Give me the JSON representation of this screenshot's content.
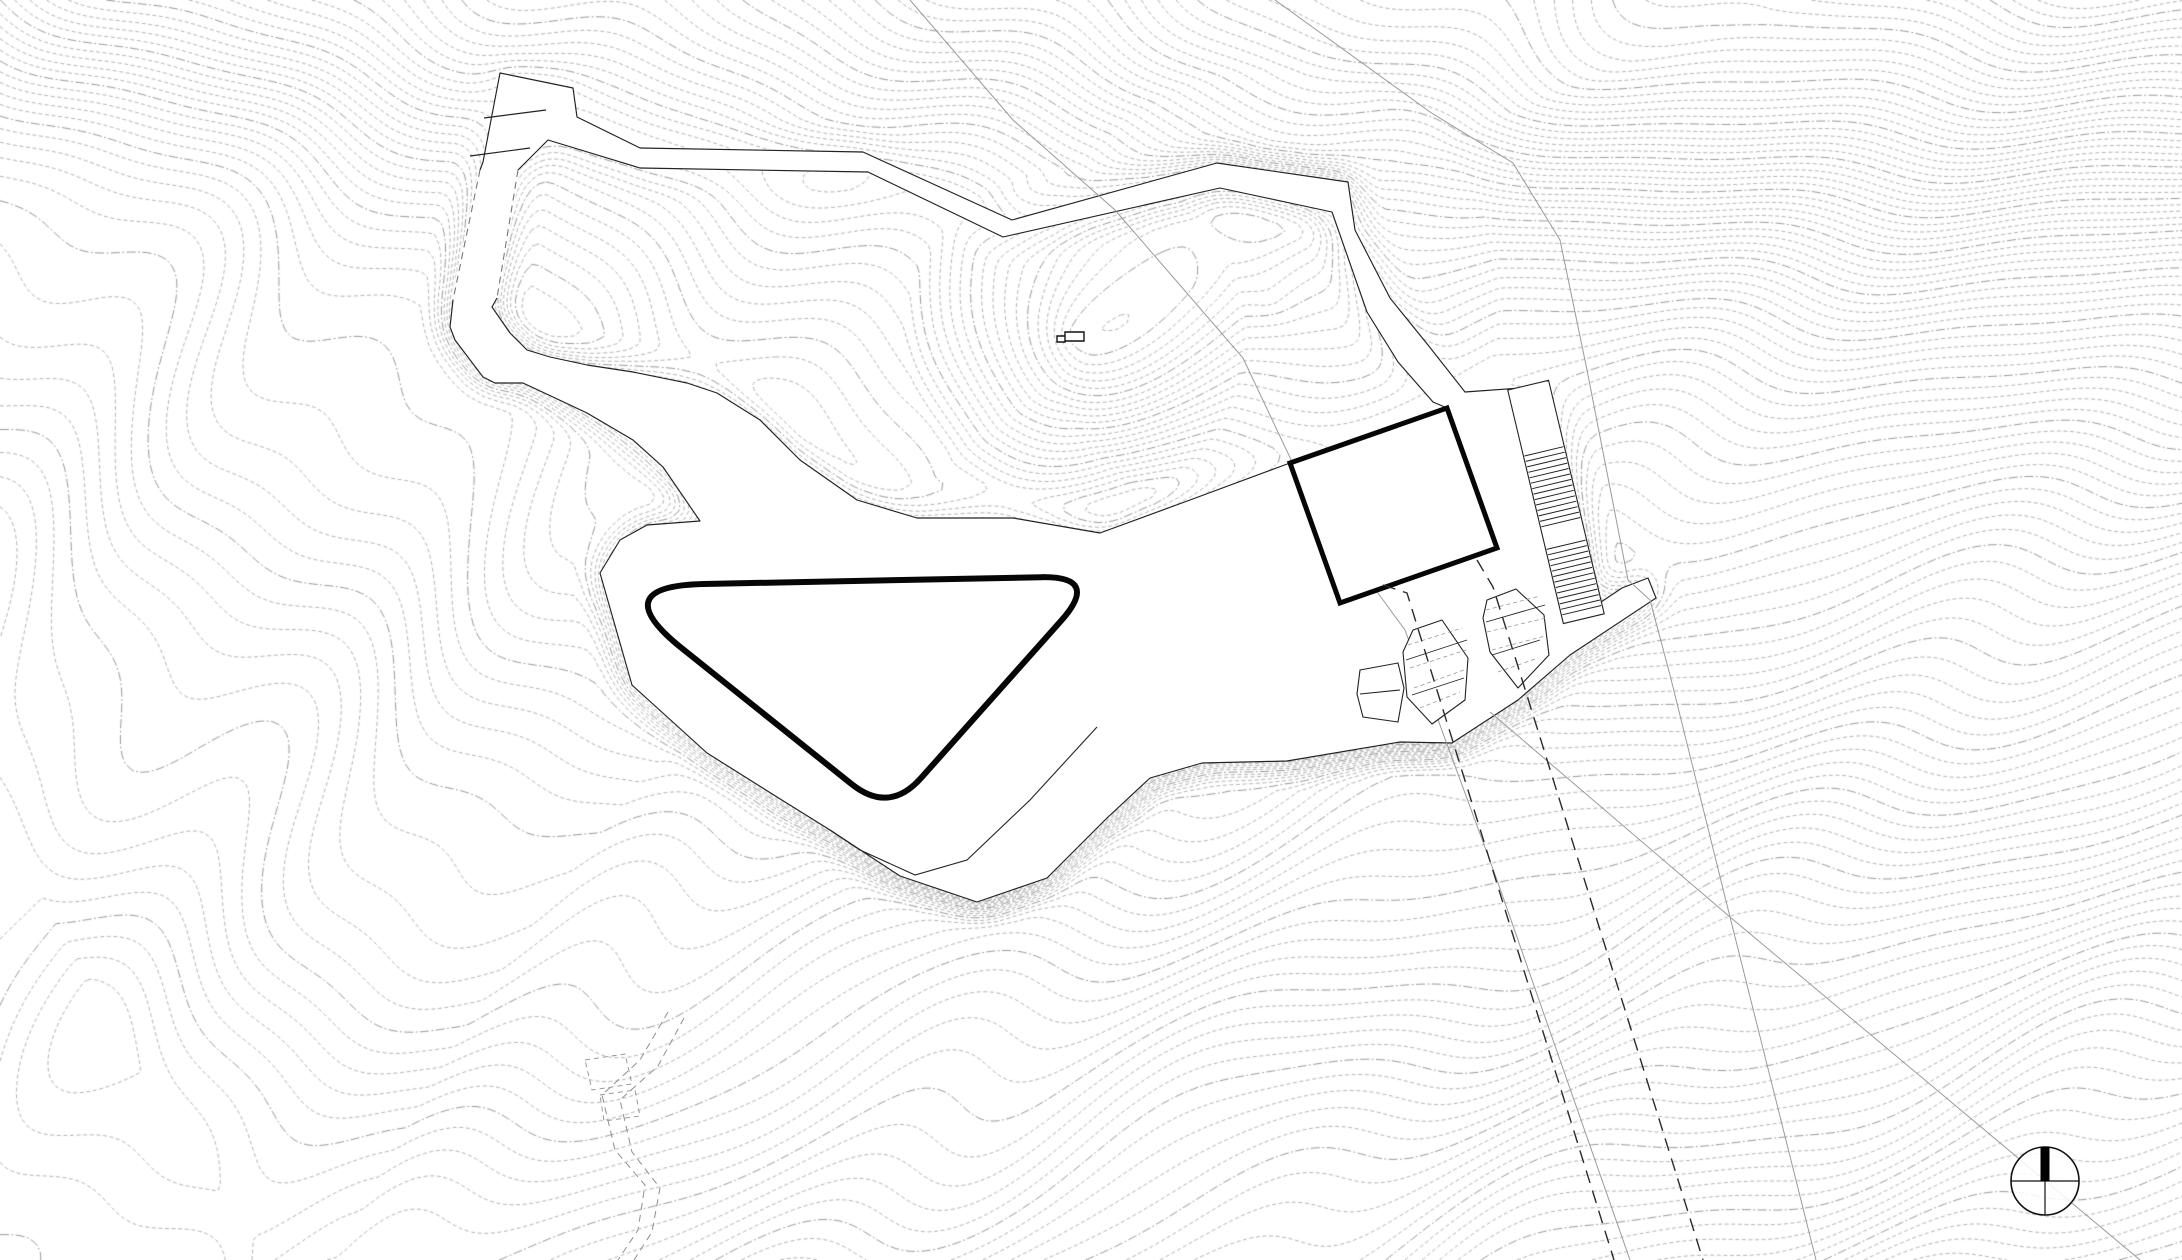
{
  "drawing": {
    "kind": "architectural-site-plan-topographic",
    "width": 2182,
    "height": 1260,
    "colors": {
      "background": "#ffffff",
      "contour": "#9c9c9c",
      "contour_index": "#8f8f8f",
      "outline": "#222222",
      "heavy": "#060606",
      "survey": "#9a9a9a",
      "centerline": "#2a2a2a",
      "trail": "#8f8f8f"
    },
    "plateau_level": 32,
    "terrain": {
      "cones": [
        {
          "cx": 2350,
          "cy": -300,
          "r": 2600,
          "a": 100
        },
        {
          "cx": 2500,
          "cy": 2300,
          "r": 2400,
          "a": -90
        },
        {
          "cx": 1075,
          "cy": 338,
          "r": 170,
          "a": 11
        },
        {
          "cx": 1270,
          "cy": 300,
          "r": 230,
          "a": 8
        }
      ],
      "tilt_x": -0.013,
      "upland": {
        "amp": 22,
        "y0": 60,
        "slope": 0.06,
        "k": 60
      },
      "waves": [
        {
          "ax": 0.016,
          "ay": 0.009,
          "amp": 1.3
        },
        {
          "ax": 0.006,
          "ay": -0.014,
          "amp": 0.9
        },
        {
          "ax": 0.028,
          "ay": 0.021,
          "amp": 0.55
        }
      ],
      "cell": 7,
      "level_step": 1,
      "index_every": 5
    },
    "pad_outer": [
      [
        500,
        73
      ],
      [
        573,
        88
      ],
      [
        577,
        117
      ],
      [
        640,
        148
      ],
      [
        863,
        152
      ],
      [
        1012,
        220
      ],
      [
        1217,
        163
      ],
      [
        1348,
        182
      ],
      [
        1355,
        230
      ],
      [
        1390,
        298
      ],
      [
        1428,
        345
      ],
      [
        1465,
        392
      ],
      [
        1549,
        386
      ],
      [
        1601,
        602
      ],
      [
        1622,
        588
      ],
      [
        1648,
        578
      ],
      [
        1656,
        598
      ],
      [
        1570,
        655
      ],
      [
        1518,
        700
      ],
      [
        1452,
        743
      ],
      [
        1400,
        742
      ],
      [
        1287,
        761
      ],
      [
        1202,
        763
      ],
      [
        1150,
        778
      ],
      [
        1107,
        818
      ],
      [
        1047,
        878
      ],
      [
        977,
        902
      ],
      [
        900,
        876
      ],
      [
        830,
        830
      ],
      [
        785,
        802
      ],
      [
        707,
        753
      ],
      [
        632,
        685
      ],
      [
        600,
        573
      ],
      [
        620,
        540
      ],
      [
        647,
        525
      ],
      [
        700,
        521
      ],
      [
        663,
        467
      ],
      [
        633,
        440
      ],
      [
        587,
        413
      ],
      [
        553,
        397
      ],
      [
        523,
        383
      ],
      [
        495,
        383
      ],
      [
        483,
        377
      ],
      [
        455,
        340
      ],
      [
        450,
        327
      ],
      [
        453,
        300
      ],
      [
        480,
        170
      ],
      [
        483,
        162
      ]
    ],
    "knoll_hole": [
      [
        548,
        140
      ],
      [
        640,
        168
      ],
      [
        868,
        172
      ],
      [
        1003,
        237
      ],
      [
        1220,
        188
      ],
      [
        1332,
        212
      ],
      [
        1367,
        312
      ],
      [
        1398,
        362
      ],
      [
        1433,
        402
      ],
      [
        1447,
        408
      ],
      [
        1290,
        463
      ],
      [
        1190,
        500
      ],
      [
        1100,
        533
      ],
      [
        1013,
        518
      ],
      [
        917,
        518
      ],
      [
        857,
        500
      ],
      [
        800,
        460
      ],
      [
        760,
        420
      ],
      [
        717,
        393
      ],
      [
        687,
        383
      ],
      [
        633,
        372
      ],
      [
        587,
        365
      ],
      [
        550,
        357
      ],
      [
        527,
        350
      ],
      [
        510,
        333
      ],
      [
        492,
        307
      ],
      [
        497,
        298
      ],
      [
        518,
        170
      ]
    ],
    "strip_dashed_edges": [
      [
        [
          480,
          170
        ],
        [
          453,
          300
        ]
      ],
      [
        [
          518,
          170
        ],
        [
          497,
          298
        ]
      ]
    ],
    "wall_ticks": [
      [
        [
          470,
          156
        ],
        [
          530,
          148
        ]
      ],
      [
        [
          484,
          118
        ],
        [
          546,
          110
        ]
      ]
    ],
    "pond": {
      "vertices": [
        [
          604,
          586
        ],
        [
          1101,
          576
        ],
        [
          889,
          814
        ]
      ],
      "corner_cut": [
        100,
        60,
        48
      ],
      "stroke_width": 6
    },
    "building": [
      [
        1290,
        463
      ],
      [
        1447,
        408
      ],
      [
        1497,
        548
      ],
      [
        1340,
        603
      ]
    ],
    "stairs": {
      "c0": [
        1530,
        393
      ],
      "c1": [
        1581,
        607
      ],
      "half_width": 21,
      "tread_half": 20,
      "corridor_s": [
        -8,
        232
      ],
      "flights": [
        {
          "s0": 60,
          "s1": 138,
          "step": 5.6
        },
        {
          "s0": 156,
          "s1": 226,
          "step": 5.6
        }
      ]
    },
    "terrace_planters": [
      {
        "poly": [
          [
            1413,
            630
          ],
          [
            1442,
            620
          ],
          [
            1468,
            658
          ],
          [
            1465,
            700
          ],
          [
            1432,
            724
          ],
          [
            1407,
            697
          ],
          [
            1403,
            652
          ]
        ],
        "inner": [
          [
            [
              1406,
              660
            ],
            [
              1467,
              640
            ]
          ],
          [
            [
              1412,
              695
            ],
            [
              1464,
              678
            ]
          ]
        ],
        "hatch": [
          [
            [
              1408,
              645
            ],
            [
              1462,
              628
            ]
          ],
          [
            [
              1410,
              668
            ],
            [
              1466,
              650
            ]
          ],
          [
            [
              1414,
              688
            ],
            [
              1464,
              670
            ]
          ],
          [
            [
              1420,
              708
            ],
            [
              1460,
              692
            ]
          ]
        ]
      },
      {
        "poly": [
          [
            1487,
            600
          ],
          [
            1516,
            589
          ],
          [
            1544,
            615
          ],
          [
            1549,
            655
          ],
          [
            1518,
            688
          ],
          [
            1490,
            652
          ],
          [
            1483,
            618
          ]
        ],
        "inner": [
          [
            [
              1486,
              622
            ],
            [
              1545,
              605
            ]
          ],
          [
            [
              1492,
              655
            ],
            [
              1540,
              640
            ]
          ]
        ],
        "hatch": [
          [
            [
              1486,
              610
            ],
            [
              1540,
              596
            ]
          ],
          [
            [
              1487,
              632
            ],
            [
              1546,
              618
            ]
          ],
          [
            [
              1492,
              650
            ],
            [
              1545,
              636
            ]
          ],
          [
            [
              1498,
              672
            ],
            [
              1538,
              658
            ]
          ]
        ]
      }
    ],
    "side_steps": {
      "poly": [
        [
          1360,
          670
        ],
        [
          1398,
          663
        ],
        [
          1404,
          688
        ],
        [
          1398,
          722
        ],
        [
          1363,
          717
        ],
        [
          1357,
          694
        ]
      ],
      "inner": [
        [
          [
            1360,
            694
          ],
          [
            1400,
            690
          ]
        ]
      ]
    },
    "lower_walk_inner_edge": [
      [
        1097,
        727
      ],
      [
        1030,
        800
      ],
      [
        967,
        860
      ],
      [
        915,
        875
      ],
      [
        860,
        850
      ],
      [
        830,
        830
      ]
    ],
    "walkway_centerlines": [
      [
        [
          1383,
          585
        ],
        [
          1407,
          593
        ],
        [
          1440,
          700
        ],
        [
          1530,
          990
        ],
        [
          1614,
          1260
        ]
      ],
      [
        [
          1477,
          560
        ],
        [
          1493,
          587
        ],
        [
          1515,
          657
        ],
        [
          1596,
          917
        ],
        [
          1703,
          1260
        ]
      ]
    ],
    "survey_lines": [
      [
        [
          910,
          0
        ],
        [
          1013,
          120
        ],
        [
          1115,
          210
        ],
        [
          1243,
          358
        ],
        [
          1310,
          500
        ],
        [
          1405,
          630
        ],
        [
          1497,
          880
        ],
        [
          1560,
          1060
        ],
        [
          1630,
          1260
        ]
      ],
      [
        [
          1275,
          0
        ],
        [
          1430,
          112
        ],
        [
          1513,
          163
        ],
        [
          1560,
          240
        ],
        [
          1587,
          370
        ],
        [
          1628,
          580
        ],
        [
          1650,
          600
        ],
        [
          1670,
          675
        ],
        [
          1730,
          917
        ],
        [
          1816,
          1260
        ]
      ],
      [
        [
          1490,
          712
        ],
        [
          1730,
          917
        ],
        [
          2140,
          1260
        ]
      ]
    ],
    "trail_paths": [
      [
        [
          668,
          1012
        ],
        [
          640,
          1060
        ],
        [
          602,
          1095
        ],
        [
          615,
          1150
        ],
        [
          645,
          1185
        ],
        [
          638,
          1230
        ],
        [
          618,
          1260
        ]
      ],
      [
        [
          684,
          1018
        ],
        [
          658,
          1066
        ],
        [
          620,
          1100
        ],
        [
          632,
          1152
        ],
        [
          660,
          1188
        ],
        [
          652,
          1232
        ],
        [
          634,
          1260
        ]
      ]
    ],
    "trail_beds": [
      [
        [
          585,
          1060
        ],
        [
          625,
          1054
        ],
        [
          632,
          1084
        ],
        [
          592,
          1090
        ]
      ],
      [
        [
          600,
          1095
        ],
        [
          635,
          1090
        ],
        [
          640,
          1116
        ],
        [
          604,
          1121
        ]
      ]
    ],
    "knoll_hut": [
      {
        "x": 1057,
        "y": 336,
        "w": 8,
        "h": 6
      },
      {
        "x": 1065,
        "y": 332,
        "w": 19,
        "h": 9
      }
    ],
    "north_arrow": {
      "cx": 2045,
      "cy": 1181,
      "r": 34,
      "needle_width": 9
    }
  }
}
